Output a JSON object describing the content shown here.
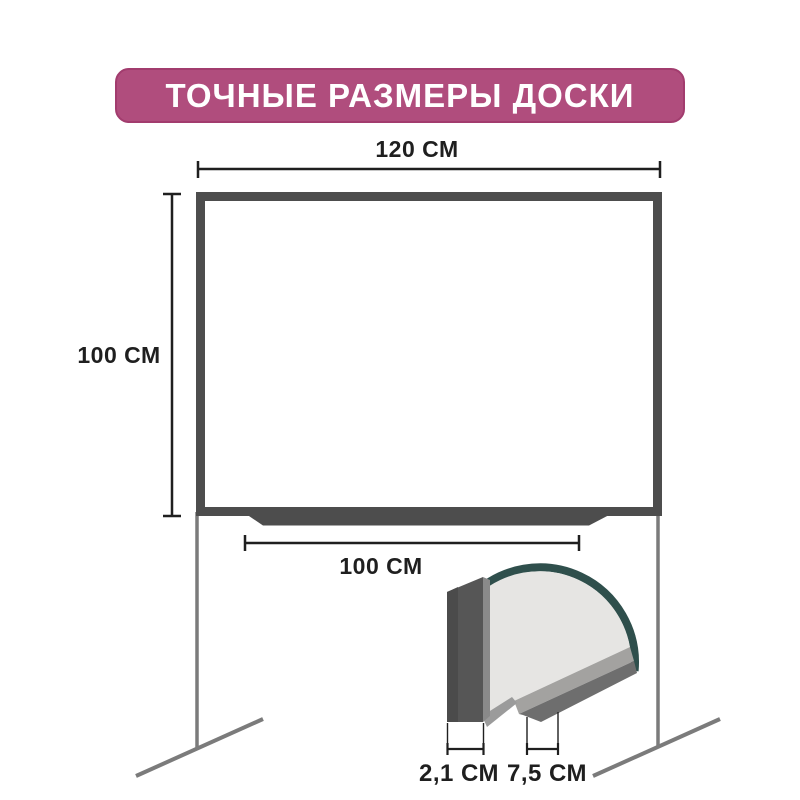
{
  "title": {
    "text": "ТОЧНЫЕ РАЗМЕРЫ ДОСКИ"
  },
  "dimensions": {
    "board_width": "120 СМ",
    "board_height": "100 СМ",
    "tray_width": "100 СМ",
    "frame_thickness": "2,1 СМ",
    "tray_depth": "7,5 СМ"
  },
  "colors": {
    "background": "#ffffff",
    "banner_bg": "#b04d7d",
    "banner_border": "#a23c6e",
    "banner_text": "#ffffff",
    "frame": "#4d4d4d",
    "board_fill": "#ffffff",
    "legs": "#7b7b7b",
    "dimension_lines": "#1f1f1f",
    "dimension_text": "#1f1f1f",
    "ring": "#2f4f4c",
    "slab": "#565656",
    "slab_shadow": "#4b4b4b",
    "slab_edge": "#8a8a8a",
    "surface": "#e6e5e3",
    "surface_edge": "#9b9b9b",
    "tray_top_face": "#a3a2a0",
    "tray_under_face": "#6e6e6e"
  }
}
